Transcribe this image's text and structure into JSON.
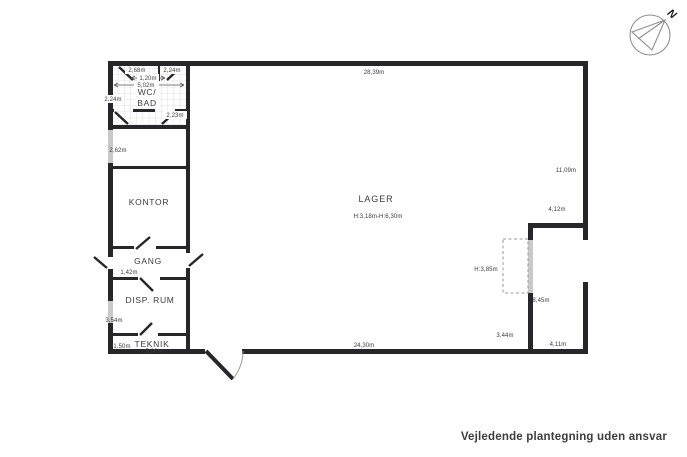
{
  "page": {
    "footer_note": "Vejledende plantegning uden ansvar"
  },
  "compass": {
    "north_label": "N"
  },
  "colors": {
    "wall": "#26262b",
    "text": "#3b3b3b",
    "window": "#c9c9c9",
    "tile_line": "#dedede"
  },
  "rooms": {
    "wc_bad_line1": "WC/",
    "wc_bad_line2": "BAD",
    "kontor": "KONTOR",
    "gang": "GANG",
    "disp_rum": "DISP. RUM",
    "teknik": "TEKNIK",
    "lager": "LAGER",
    "lager_heights": "H:3,18m-H:6,30m"
  },
  "measurements": {
    "top_total": "28,39m",
    "wc_top_left": "2,68m",
    "wc_top_right": "2,24m",
    "wc_inner_width": "1,20m",
    "wc_width": "5,02m",
    "wc_left": "2,24m",
    "wc_right": "2,23m",
    "entry_left": "2,62m",
    "gang_width": "1,42m",
    "disp_height": "3,54m",
    "teknik_height": "1,50m",
    "teknik_width": "5,06m",
    "lager_bottom": "24,30m",
    "right_upper": "11,09m",
    "step_width": "4,12m",
    "gate_height": "H:3,85m",
    "inner_right": "8,45m",
    "lager_right": "3,44m",
    "bottom_right": "4,11m"
  }
}
